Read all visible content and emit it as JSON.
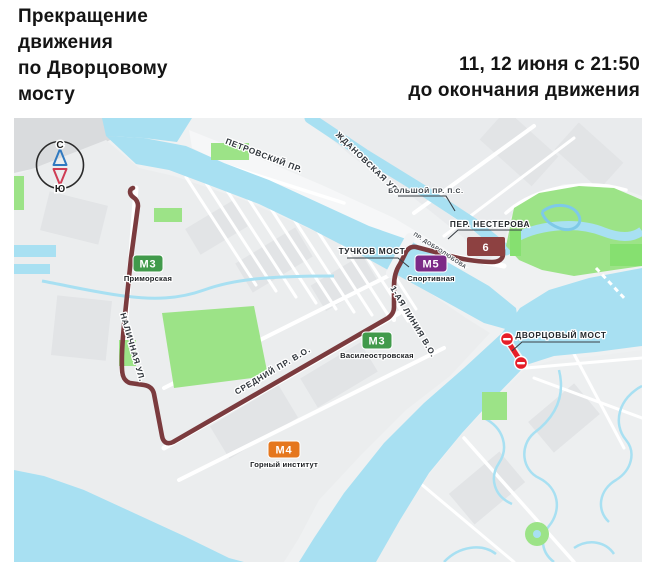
{
  "header": {
    "title": {
      "full": "Прекращение движения по Дворцовому мосту",
      "lines": [
        "Прекращение",
        "движения",
        "по Дворцовому",
        "мосту"
      ]
    },
    "schedule": {
      "full": "11, 12 июня с 21:50 до окончания движения",
      "lines": [
        "11, 12 июня с 21:50",
        "до окончания движения"
      ]
    }
  },
  "map": {
    "compass": {
      "north": "С",
      "south": "Ю",
      "north_color": "#3079c0",
      "south_color": "#cf3c54"
    },
    "route": {
      "number": "6",
      "color": "#7b3b3e",
      "badge_color": "#8d4141"
    },
    "closure": {
      "bridge": "ДВОРЦОВЫЙ МОСТ",
      "color": "#e61e28"
    },
    "bridge_labels": {
      "tuchkov": "ТУЧКОВ МОСТ",
      "dvortsovy": "ДВОРЦОВЫЙ МОСТ"
    },
    "streets": [
      "ПЕТРОВСКИЙ ПР.",
      "ЖДАНОВСКАЯ УЛ.",
      "БОЛЬШОЙ ПР. П.С.",
      "ПЕР. НЕСТЕРОВА",
      "НАЛИЧНАЯ УЛ.",
      "СРЕДНИЙ ПР. В.О.",
      "1-АЯ ЛИНИЯ В.О.",
      "ПР. ДОБРОЛЮБОВА"
    ],
    "metro_stations": [
      {
        "label": "М3",
        "name": "Приморская",
        "color": "#419a4b"
      },
      {
        "label": "М5",
        "name": "Спортивная",
        "color": "#7c2a87"
      },
      {
        "label": "М3",
        "name": "Василеостровская",
        "color": "#419a4b"
      },
      {
        "label": "М4",
        "name": "Горный институт",
        "color": "#e5771e"
      }
    ],
    "palette": {
      "water": "#a8e0f2",
      "park": "#9ce387",
      "park_bright": "#86e070",
      "land": "#eff1f2"
    }
  }
}
